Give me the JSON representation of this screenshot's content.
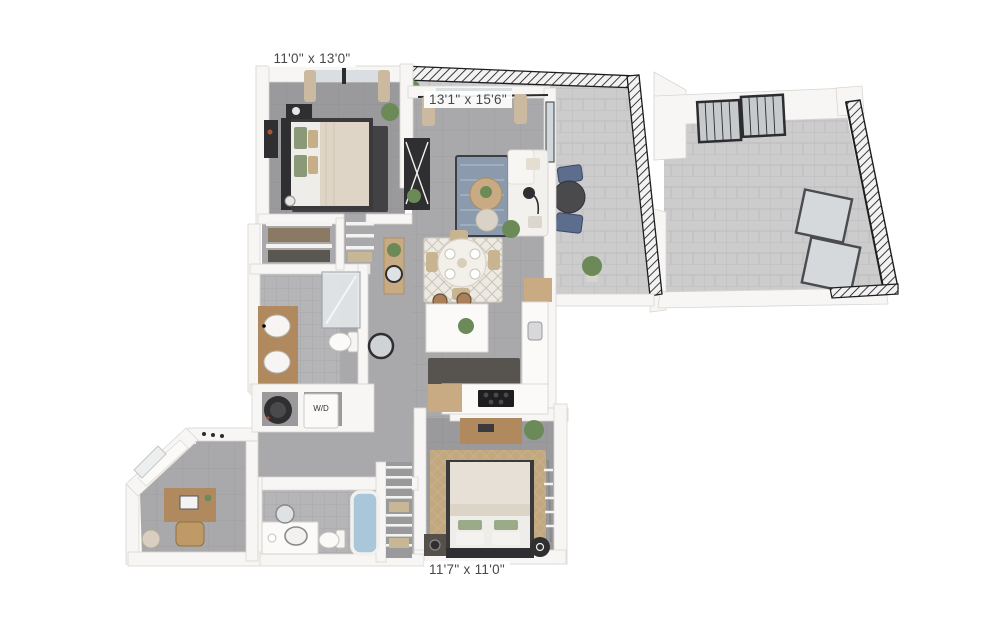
{
  "labels": {
    "bedroom1_dimensions": "11'0\" x 13'0\"",
    "living_dimensions": "13'1\" x 15'6\"",
    "bedroom2_dimensions": "11'7\" x 11'0\"",
    "washer_dryer": "W/D"
  },
  "colors": {
    "background": "#ffffff",
    "wall": "#f7f6f4",
    "wall_edge": "#d9d6d2",
    "floor": "#a9a9ab",
    "floor_dark": "#9a9a9c",
    "floor_bath": "#b5b5b7",
    "floor_outdoor": "#cccccd",
    "railing": "#1e1e20",
    "wood": "#b08a5e",
    "wood_light": "#c8ab82",
    "dark_furniture": "#2f2f31",
    "plant": "#6b8a58",
    "rug_blue": "#8b9aac",
    "rug_dark": "#424244",
    "rug_tan": "#c3a87d",
    "rug_dining": "#edeae3",
    "sofa": "#f2f1ee",
    "tub_blue": "#aac7da",
    "chair_blue": "#5c6d8d",
    "label_text": "#474747"
  }
}
